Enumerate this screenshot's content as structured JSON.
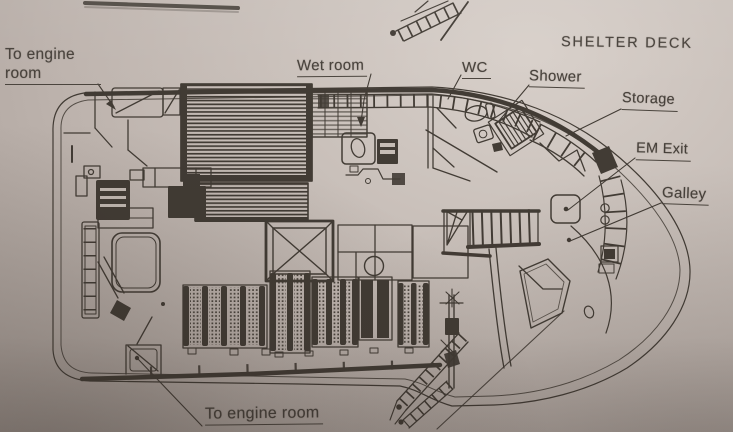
{
  "page": {
    "title": "SHELTER DECK"
  },
  "labels": {
    "shelter_deck": "SHELTER DECK",
    "engine_room_top": {
      "line1": "To engine",
      "line2": "room"
    },
    "wet_room": "Wet room",
    "wc": "WC",
    "shower": "Shower",
    "storage": "Storage",
    "em_exit": "EM Exit",
    "galley": "Galley",
    "engine_room_bottom": "To engine room"
  },
  "colors": {
    "paper": "#c7beb8",
    "ink": "#38322b",
    "label_text": "#46403a"
  }
}
